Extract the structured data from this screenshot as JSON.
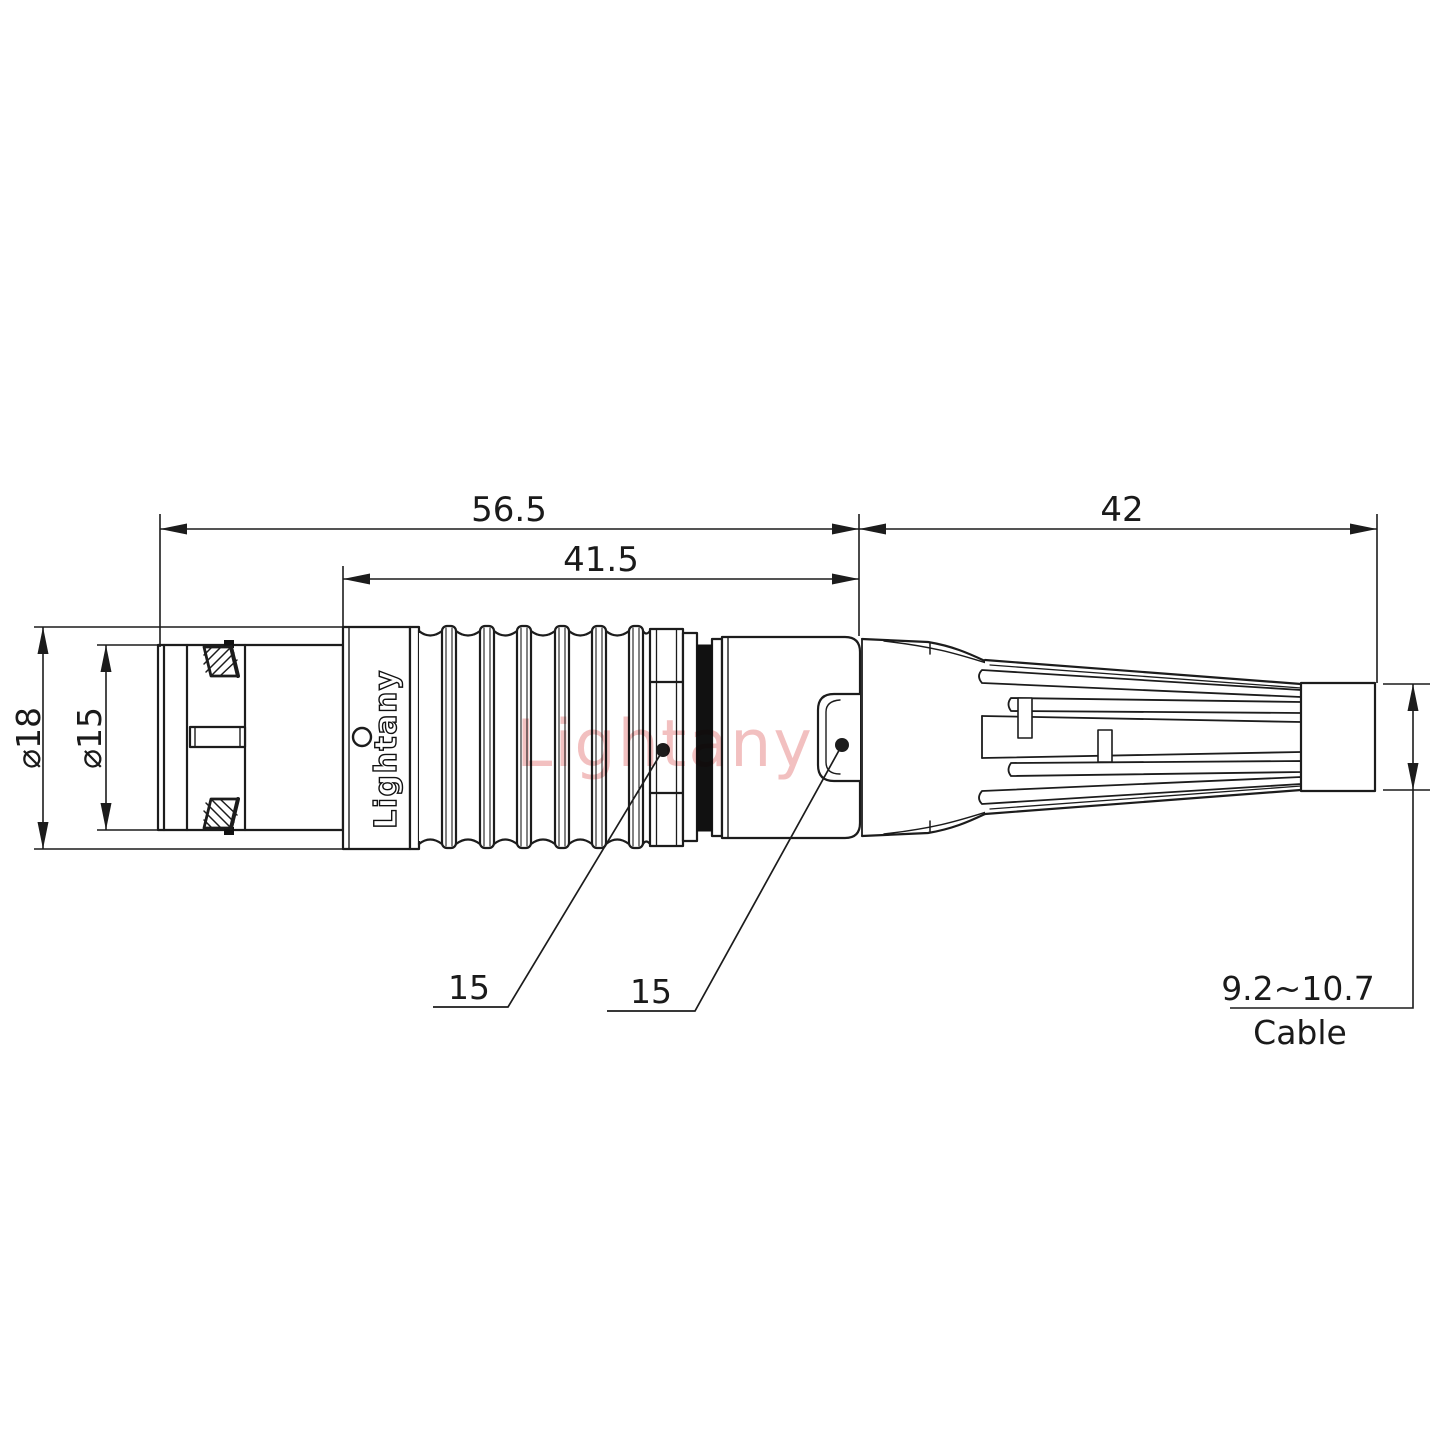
{
  "drawing": {
    "watermark": "Lightany",
    "engraving": "Lightany",
    "dims": {
      "overall": "56.5",
      "body": "41.5",
      "rear": "42",
      "dia_outer": "⌀18",
      "dia_nose": "⌀15",
      "callout1": "15",
      "callout2": "15",
      "cable_range": "9.2~10.7",
      "cable_label": "Cable"
    },
    "colors": {
      "line": "#1c1c1c",
      "watermark_pink": "#f2c0c0"
    }
  }
}
